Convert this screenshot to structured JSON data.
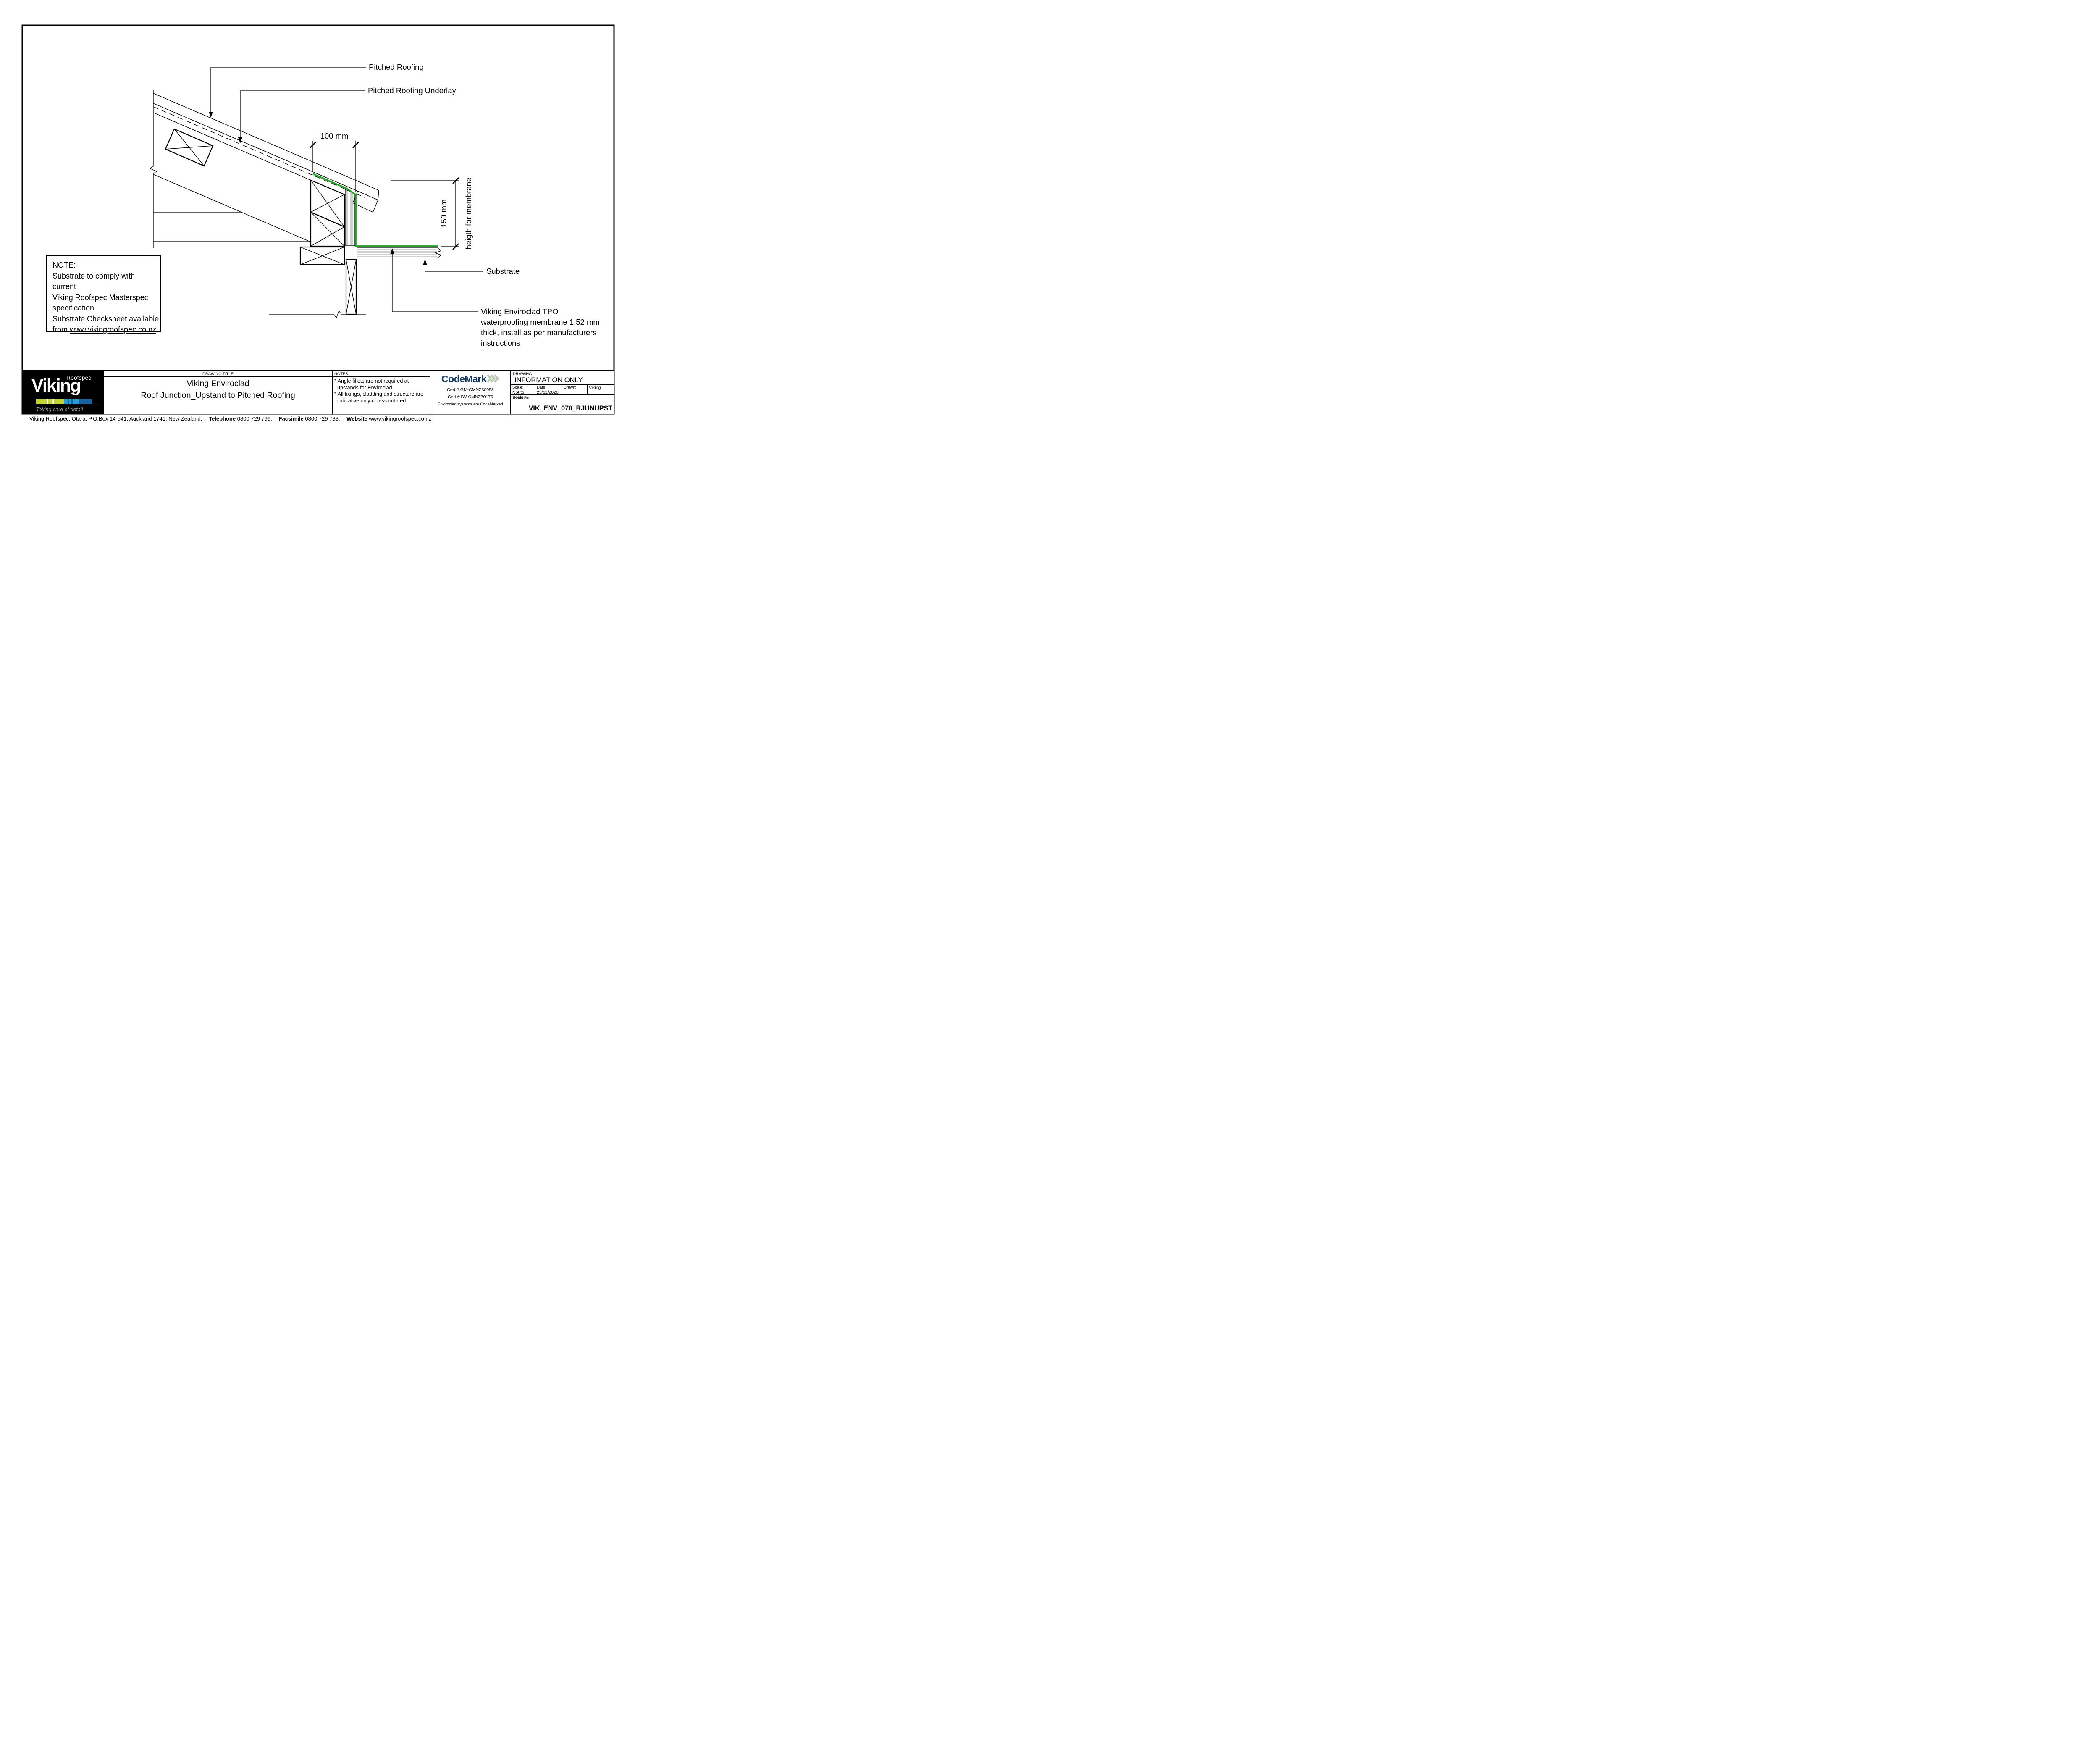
{
  "colors": {
    "membrane_green": "#1ea51e",
    "hatch_gray": "#b3b3b3",
    "logo_lime": "#c3d32f",
    "logo_blue_light": "#239dd8",
    "logo_blue_dark": "#15629f",
    "codemark_navy": "#16396d",
    "codemark_chevron": "#b8cbb0",
    "tagline_gray": "#9a9a9a"
  },
  "drawing": {
    "labels": {
      "pitched_roofing": "Pitched Roofing",
      "pitched_roofing_underlay": "Pitched Roofing Underlay",
      "dim_width": "100 mm",
      "dim_height": "150 mm",
      "dim_height_note": "heigth for membrane",
      "substrate": "Substrate",
      "membrane_line1": "Viking Enviroclad TPO",
      "membrane_line2": "waterproofing membrane 1.52 mm",
      "membrane_line3": "thick, install as per manufacturers",
      "membrane_line4": "instructions"
    },
    "note_box": {
      "title": "NOTE:",
      "line1": "Substrate to comply with current",
      "line2": "Viking Roofspec Masterspec",
      "line3": "specification",
      "line4": "Substrate Checksheet available",
      "line5_prefix": "from ",
      "line5_link": "www.vikingroofspec.co.nz"
    }
  },
  "title_block": {
    "logo": {
      "brand": "Viking",
      "sub_brand": "Roofspec",
      "tagline": "Taking care of detail"
    },
    "drawing_title": {
      "header": "DRAWING TITLE",
      "line1": "Viking Enviroclad",
      "line2": "Roof Junction_Upstand to Pitched Roofing"
    },
    "notes": {
      "header": "NOTES:",
      "item1_line1": "* Angle fillets are not required at",
      "item1_line2": "upstands for Enviroclad",
      "item2_line1": "* All fixings, cladding and structure are",
      "item2_line2": "indicative only unless notated"
    },
    "codemark": {
      "brand": "CodeMark",
      "cert1": "Cert # GM-CMNZ30058",
      "cert2": "Cert # BV-CMNZ70176",
      "tagline": "Enviroclad systems are CodeMarked"
    },
    "info": {
      "header": "DRAWING",
      "status": "INFORMATION ONLY",
      "scale_label": "Scale:",
      "scale_value": "Not to Scale",
      "date_label": "Date:",
      "date_value": "23/11/2020",
      "drawn_label": "Drawn:",
      "drawn_value": "Viking",
      "detail_ref_label": "Detail Ref:",
      "detail_ref_value": "VIK_ENV_070_RJUNUPST"
    }
  },
  "footer": {
    "address": "Viking Roofspec, Otara, P.O.Box 14-541, Auckland 1741, New Zealand,",
    "telephone_label": "Telephone",
    "telephone": "0800 729 799,",
    "facsimile_label": "Facsimile",
    "facsimile": "0800 729 788,",
    "website_label": "Website",
    "website": "www.vikingroofspec.co.nz"
  }
}
